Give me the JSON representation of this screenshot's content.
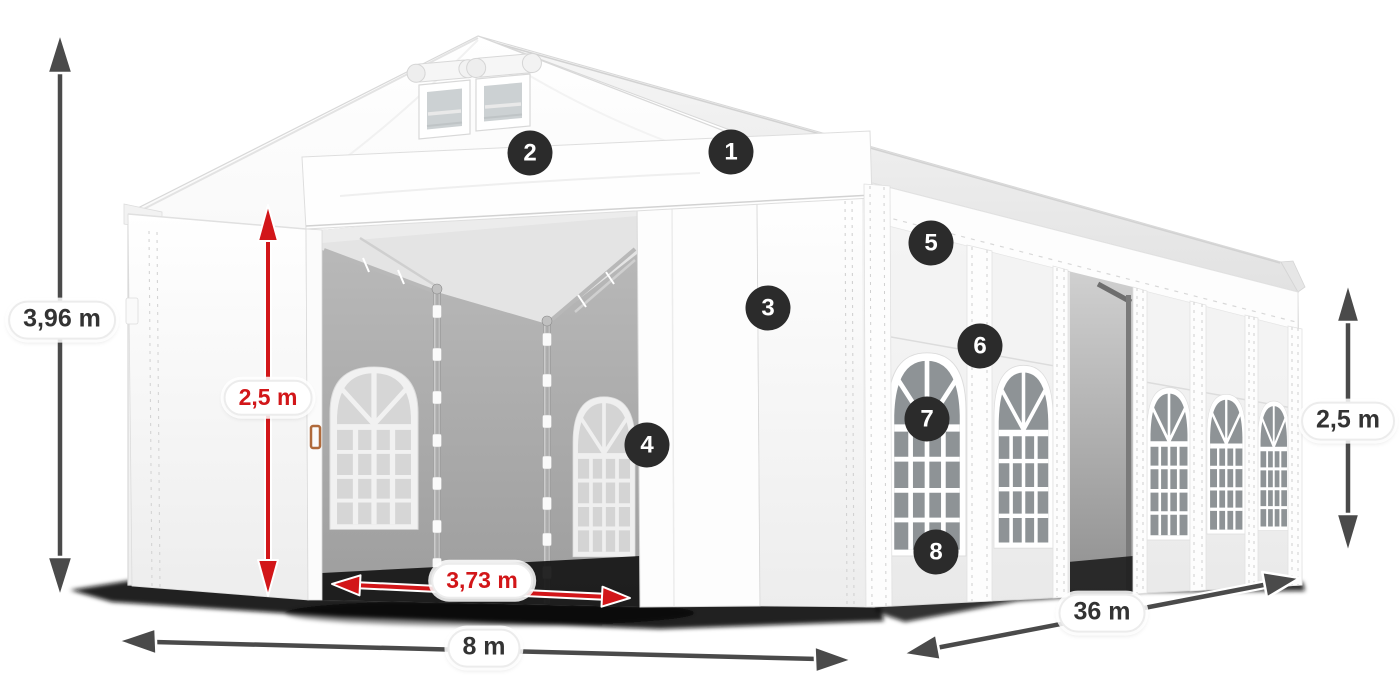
{
  "dimension_labels": {
    "total_height": "3,96 m",
    "door_height": "2,5 m",
    "door_width": "3,73 m",
    "front_width": "8 m",
    "side_length": "36 m",
    "side_wall_height": "2,5 m"
  },
  "feature_markers": [
    {
      "number": "1"
    },
    {
      "number": "2"
    },
    {
      "number": "3"
    },
    {
      "number": "4"
    },
    {
      "number": "5"
    },
    {
      "number": "6"
    },
    {
      "number": "7"
    },
    {
      "number": "8"
    }
  ],
  "colors": {
    "dimension_red": "#d21619",
    "dimension_gray": "#4a4a4a",
    "label_text_dark": "#333333",
    "marker_background": "#2b2b2b",
    "marker_text": "#ffffff",
    "tent_white": "#ffffff",
    "interior_gray": "#b0b0b0",
    "window_glass": "#8e9396"
  }
}
